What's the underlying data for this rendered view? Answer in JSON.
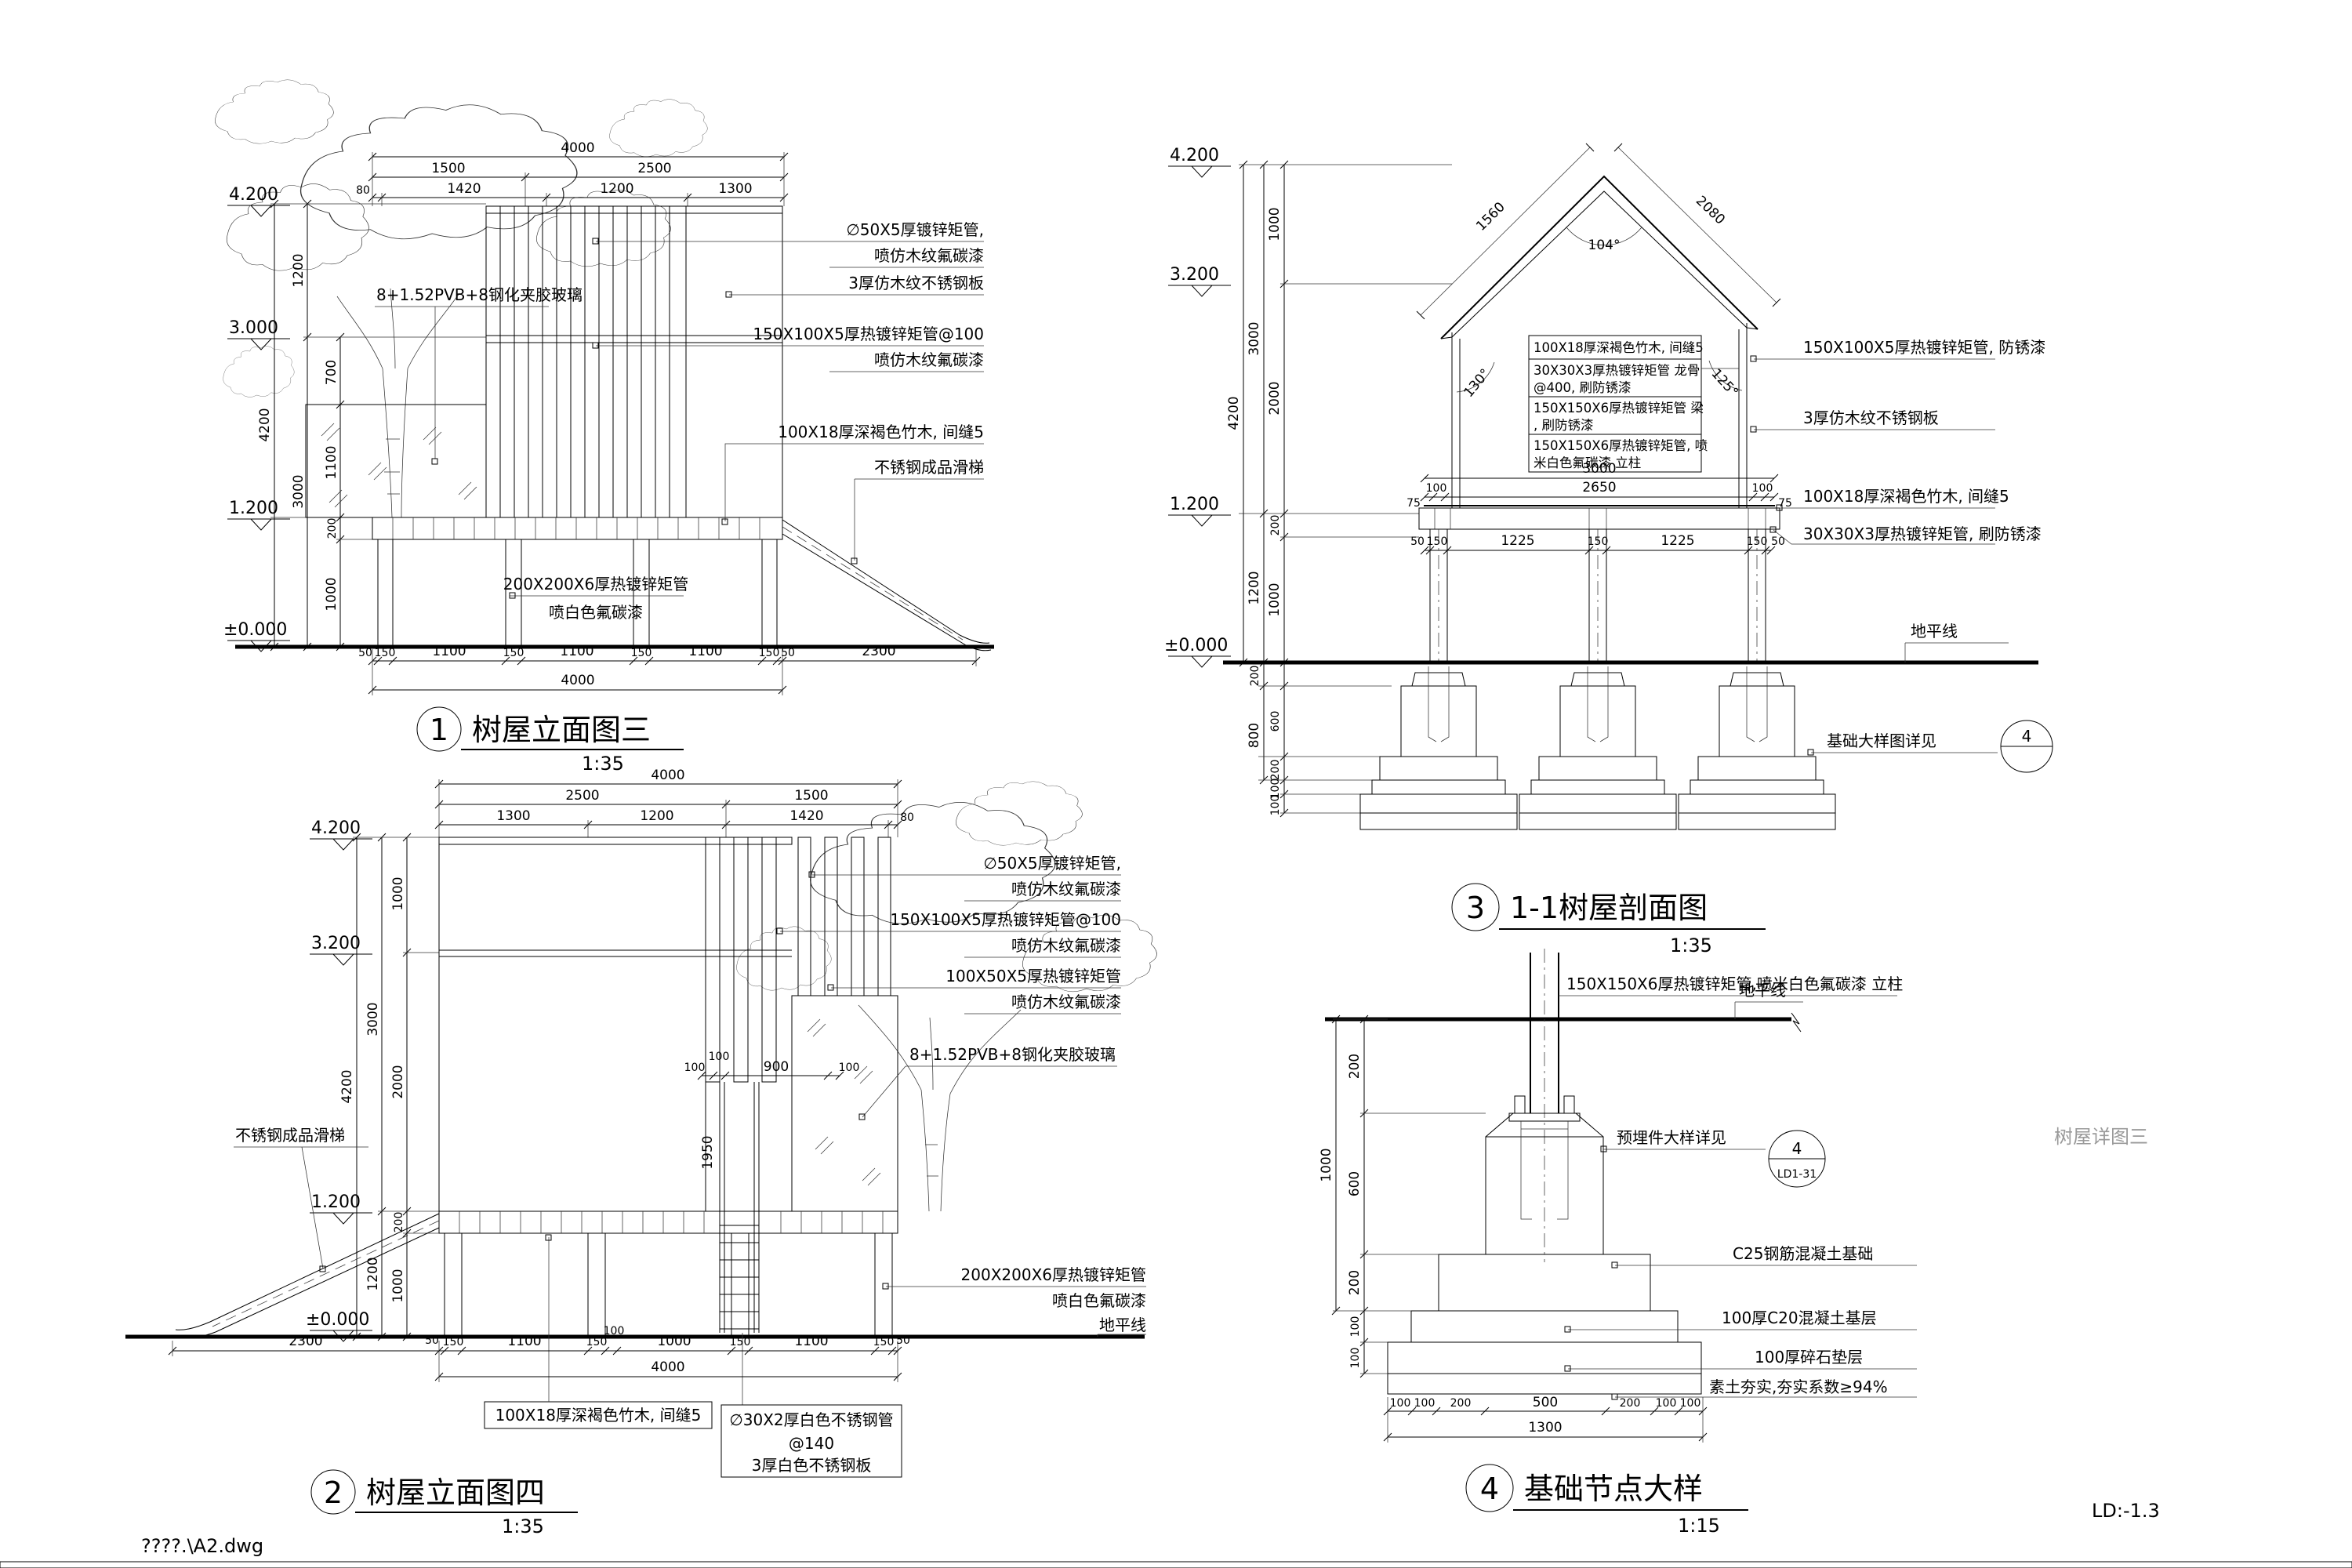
{
  "page": {
    "file_label": "????.\\A2.dwg",
    "sheet_no": "LD:-1.3",
    "side_note": "树屋详图三"
  },
  "d1": {
    "title_no": "1",
    "title": "树屋立面图三",
    "scale": "1:35",
    "levels": [
      "4.200",
      "3.000",
      "1.200",
      "±0.000"
    ],
    "top_r1": [
      "4000"
    ],
    "top_r2": [
      "1500",
      "2500"
    ],
    "top_r3": [
      "80",
      "1420",
      "1200",
      "1300"
    ],
    "left_outer": "4200",
    "left_mid": [
      "1200",
      "3000"
    ],
    "left_inner": [
      "700",
      "1100",
      "200",
      "1000"
    ],
    "bottom_r1": [
      "50",
      "150",
      "1100",
      "150",
      "1100",
      "150",
      "1100",
      "150",
      "50"
    ],
    "slide_dim": "2300",
    "bottom_r2": "4000",
    "glass_label": "8+1.52PVB+8钢化夹胶玻璃",
    "ann": [
      "∅50X5厚镀锌矩管,",
      "喷仿木纹氟碳漆",
      "3厚仿木纹不锈钢板",
      "150X100X5厚热镀锌矩管@100",
      "喷仿木纹氟碳漆",
      "100X18厚深褐色竹木, 间缝5",
      "不锈钢成品滑梯"
    ],
    "base_ann": [
      "200X200X6厚热镀锌矩管",
      "喷白色氟碳漆"
    ]
  },
  "d2": {
    "title_no": "2",
    "title": "树屋立面图四",
    "scale": "1:35",
    "levels": [
      "4.200",
      "3.200",
      "1.200",
      "±0.000"
    ],
    "top_r1": [
      "4000"
    ],
    "top_r2": [
      "2500",
      "1500"
    ],
    "top_r3": [
      "1300",
      "1200",
      "1420",
      "80"
    ],
    "left_outer": "4200",
    "left_mid": [
      "3000",
      "1200"
    ],
    "left_inner": [
      "1000",
      "2000",
      "200",
      "1000"
    ],
    "mid_dims": [
      "100",
      "100",
      "900",
      "100"
    ],
    "ladder_dim": "1950",
    "slide_dim": "2300",
    "bottom_r1": [
      "50",
      "150",
      "1100",
      "150",
      "100",
      "1000",
      "150",
      "1100",
      "150",
      "50"
    ],
    "bottom_r2": "4000",
    "glass_label": "8+1.52PVB+8钢化夹胶玻璃",
    "slide_label": "不锈钢成品滑梯",
    "ann": [
      "∅50X5厚镀锌矩管,",
      "喷仿木纹氟碳漆",
      "150X100X5厚热镀锌矩管@100",
      "喷仿木纹氟碳漆",
      "100X50X5厚热镀锌矩管",
      "喷仿木纹氟碳漆"
    ],
    "base_ann": [
      "200X200X6厚热镀锌矩管",
      "喷白色氟碳漆",
      "地平线"
    ],
    "under_ann": [
      "100X18厚深褐色竹木, 间缝5",
      "∅30X2厚白色不锈钢管",
      "@140",
      "3厚白色不锈钢板"
    ]
  },
  "d3": {
    "title_no": "3",
    "title": "1-1树屋剖面图",
    "scale": "1:35",
    "levels": [
      "4.200",
      "3.200",
      "1.200",
      "±0.000"
    ],
    "roof_dims": [
      "1560",
      "2080"
    ],
    "angles": [
      "104°",
      "130°",
      "125°"
    ],
    "left_outer": "4200",
    "left_mid": [
      "3000",
      "1200"
    ],
    "left_inner": [
      "1000",
      "2000",
      "200",
      "1000"
    ],
    "below_outer": [
      "200",
      "800"
    ],
    "below_inner": [
      "600",
      "200",
      "100",
      "100"
    ],
    "plat_r1": "3000",
    "plat_r2": [
      "75",
      "100",
      "2650",
      "100",
      "75"
    ],
    "plat_r3": [
      "50",
      "150",
      "1225",
      "150",
      "1225",
      "150",
      "50"
    ],
    "notes": [
      "100X18厚深褐色竹木, 间缝5",
      "30X30X3厚热镀锌矩管 龙骨",
      "@400, 刷防锈漆",
      "150X150X6厚热镀锌矩管 梁",
      ", 刷防锈漆",
      "150X150X6厚热镀锌矩管, 喷",
      "米白色氟碳漆 立柱"
    ],
    "right_ann": [
      "150X100X5厚热镀锌矩管, 防锈漆",
      "3厚仿木纹不锈钢板",
      "100X18厚深褐色竹木, 间缝5",
      "30X30X3厚热镀锌矩管, 刷防锈漆",
      "地平线",
      "基础大样图详见"
    ],
    "detail_ref": "4"
  },
  "d4": {
    "title_no": "4",
    "title": "基础节点大样",
    "scale": "1:15",
    "top_note": "150X150X6厚热镀锌矩管,喷米白色氟碳漆  立柱",
    "ground_label": "地平线",
    "ann": [
      "预埋件大样详见",
      "C25钢筋混凝土基础",
      "100厚C20混凝土基层",
      "100厚碎石垫层",
      "素土夯实,夯实系数≥94%"
    ],
    "ref_no": "4",
    "ref_code": "LD1-31",
    "left_dims": [
      "200",
      "600",
      "200",
      "100",
      "100"
    ],
    "left_outer": "1000",
    "bottom_dims": [
      "100",
      "100",
      "200",
      "500",
      "200",
      "100",
      "100"
    ],
    "bottom_total": "1300"
  }
}
